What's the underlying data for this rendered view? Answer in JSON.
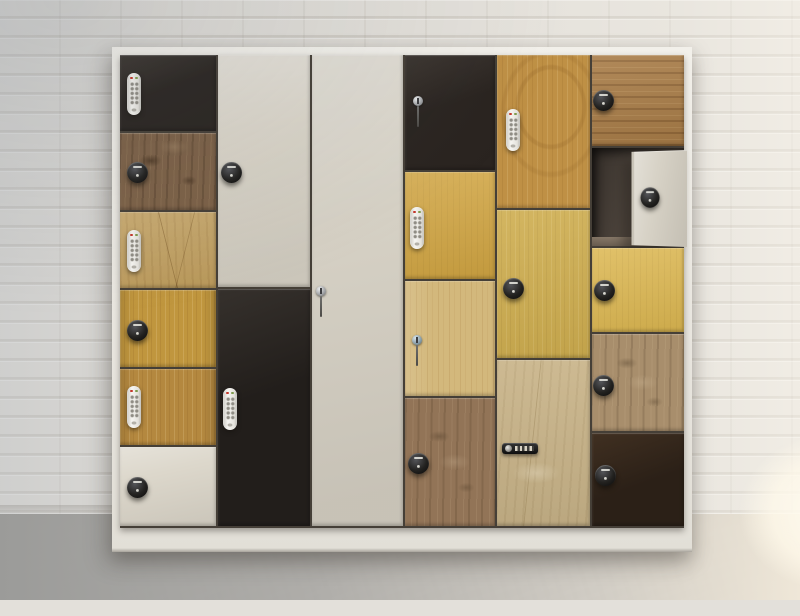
{
  "scene": {
    "setting": "showroom photo of a mixed-finish locker cabinet against a white painted brick wall on a gray concrete floor",
    "wall_color": "#e2dfd9",
    "mortar_color": "#948c80",
    "floor_color": "#a9a8a5",
    "sunlight_glow_color": "#fff9ec",
    "wall_floor_line_y": 514
  },
  "cabinet": {
    "label": "six-column multi-door locker bank with assorted door finishes and locks",
    "frame_color": "#ecebe4",
    "gap_color": "#453f37",
    "x": 112,
    "y": 47,
    "width": 580,
    "height": 505,
    "doors_area": {
      "x": 120,
      "y": 55,
      "width": 564,
      "height": 473
    },
    "plinth": {
      "y": 528,
      "height": 24,
      "color": "#e9e6df"
    },
    "columns": [
      {
        "name": "column-1",
        "x": 120,
        "width": 96,
        "doors": [
          {
            "finish": "black",
            "color": "#2a2521",
            "y": 55,
            "height": 76,
            "lock": {
              "type": "keypad",
              "cx": 134,
              "cy": 94
            }
          },
          {
            "finish": "rustic-dark",
            "color": "#7c6147",
            "y": 133,
            "height": 77,
            "lock": {
              "type": "knob",
              "cx": 137,
              "cy": 172
            }
          },
          {
            "finish": "oak-cracked",
            "color": "#c2a05f",
            "y": 212,
            "height": 76,
            "lock": {
              "type": "keypad",
              "cx": 134,
              "cy": 251
            }
          },
          {
            "finish": "oak-v",
            "color": "#c0963e",
            "y": 290,
            "height": 77,
            "lock": {
              "type": "knob",
              "cx": 137,
              "cy": 330
            }
          },
          {
            "finish": "oak-v",
            "color": "#b4883f",
            "y": 369,
            "height": 76,
            "lock": {
              "type": "keypad",
              "cx": 134,
              "cy": 407
            }
          },
          {
            "finish": "cream",
            "color": "#dcd7cb",
            "y": 447,
            "height": 79,
            "lock": {
              "type": "knob",
              "cx": 137,
              "cy": 487
            }
          }
        ]
      },
      {
        "name": "column-2",
        "x": 218,
        "width": 92,
        "doors": [
          {
            "finish": "cream",
            "color": "#dad5c9",
            "y": 55,
            "height": 232,
            "lock": {
              "type": "knob",
              "cx": 231,
              "cy": 172
            }
          },
          {
            "finish": "black",
            "color": "#221e1b",
            "y": 289,
            "height": 237,
            "lock": {
              "type": "keypad",
              "cx": 230,
              "cy": 409
            }
          }
        ]
      },
      {
        "name": "column-3",
        "x": 312,
        "width": 91,
        "doors": [
          {
            "finish": "cream",
            "color": "#d6d1c5",
            "y": 55,
            "height": 471,
            "lock": {
              "type": "key",
              "cx": 321,
              "cy": 291
            }
          }
        ]
      },
      {
        "name": "column-4",
        "x": 405,
        "width": 90,
        "doors": [
          {
            "finish": "black",
            "color": "#2a2420",
            "y": 55,
            "height": 115,
            "lock": {
              "type": "key",
              "cx": 418,
              "cy": 101
            }
          },
          {
            "finish": "yellow",
            "color": "#d1a542",
            "y": 172,
            "height": 107,
            "lock": {
              "type": "keypad",
              "cx": 417,
              "cy": 228
            }
          },
          {
            "finish": "pine-pale",
            "color": "#d3b87c",
            "y": 281,
            "height": 115,
            "lock": {
              "type": "key",
              "variant": "blue",
              "cx": 417,
              "cy": 340
            }
          },
          {
            "finish": "rustic-gray",
            "color": "#927457",
            "y": 398,
            "height": 128,
            "lock": {
              "type": "knob",
              "cx": 418,
              "cy": 463
            }
          }
        ]
      },
      {
        "name": "column-5",
        "x": 497,
        "width": 93,
        "doors": [
          {
            "finish": "oak-cathedral",
            "color": "#bf9045",
            "y": 55,
            "height": 153,
            "lock": {
              "type": "keypad",
              "cx": 513,
              "cy": 130
            }
          },
          {
            "finish": "yellow-grain",
            "color": "#cead4f",
            "y": 210,
            "height": 148,
            "lock": {
              "type": "knob",
              "cx": 513,
              "cy": 288
            }
          },
          {
            "finish": "travertine",
            "color": "#c9b489",
            "y": 360,
            "height": 166,
            "lock": {
              "type": "combo",
              "cx": 520,
              "cy": 448
            }
          }
        ]
      },
      {
        "name": "column-6",
        "x": 592,
        "width": 92,
        "doors": [
          {
            "finish": "walnut-h",
            "color": "#a87c47",
            "y": 55,
            "height": 91,
            "lock": {
              "type": "knob",
              "cx": 603,
              "cy": 100
            }
          },
          {
            "finish": "open",
            "color": "#55493f",
            "y": 148,
            "height": 98,
            "open_door": {
              "color": "#d7d2c6",
              "x": 627,
              "width": 57,
              "y": 150,
              "height": 97,
              "lock": {
                "type": "knob",
                "cx": 644,
                "cy": 197
              }
            }
          },
          {
            "finish": "yellow",
            "color": "#dcb751",
            "y": 248,
            "height": 84,
            "lock": {
              "type": "knob",
              "cx": 604,
              "cy": 290
            }
          },
          {
            "finish": "rustic-gray",
            "color": "#a88e6c",
            "y": 334,
            "height": 97,
            "lock": {
              "type": "knob",
              "cx": 603,
              "cy": 385
            }
          },
          {
            "finish": "black-brown",
            "color": "#2b2017",
            "y": 433,
            "height": 93,
            "lock": {
              "type": "knob",
              "cx": 605,
              "cy": 475
            }
          }
        ]
      }
    ]
  },
  "lock_types": {
    "keypad": "white vertical push-button digital keypad lock with red and green LEDs",
    "knob": "round black digital cam-lock knob with small label and silver pin",
    "key": "silver cylinder key lock with key inserted and cord hanging",
    "combo": "black horizontal 4-dial combination lock with silver dial"
  }
}
